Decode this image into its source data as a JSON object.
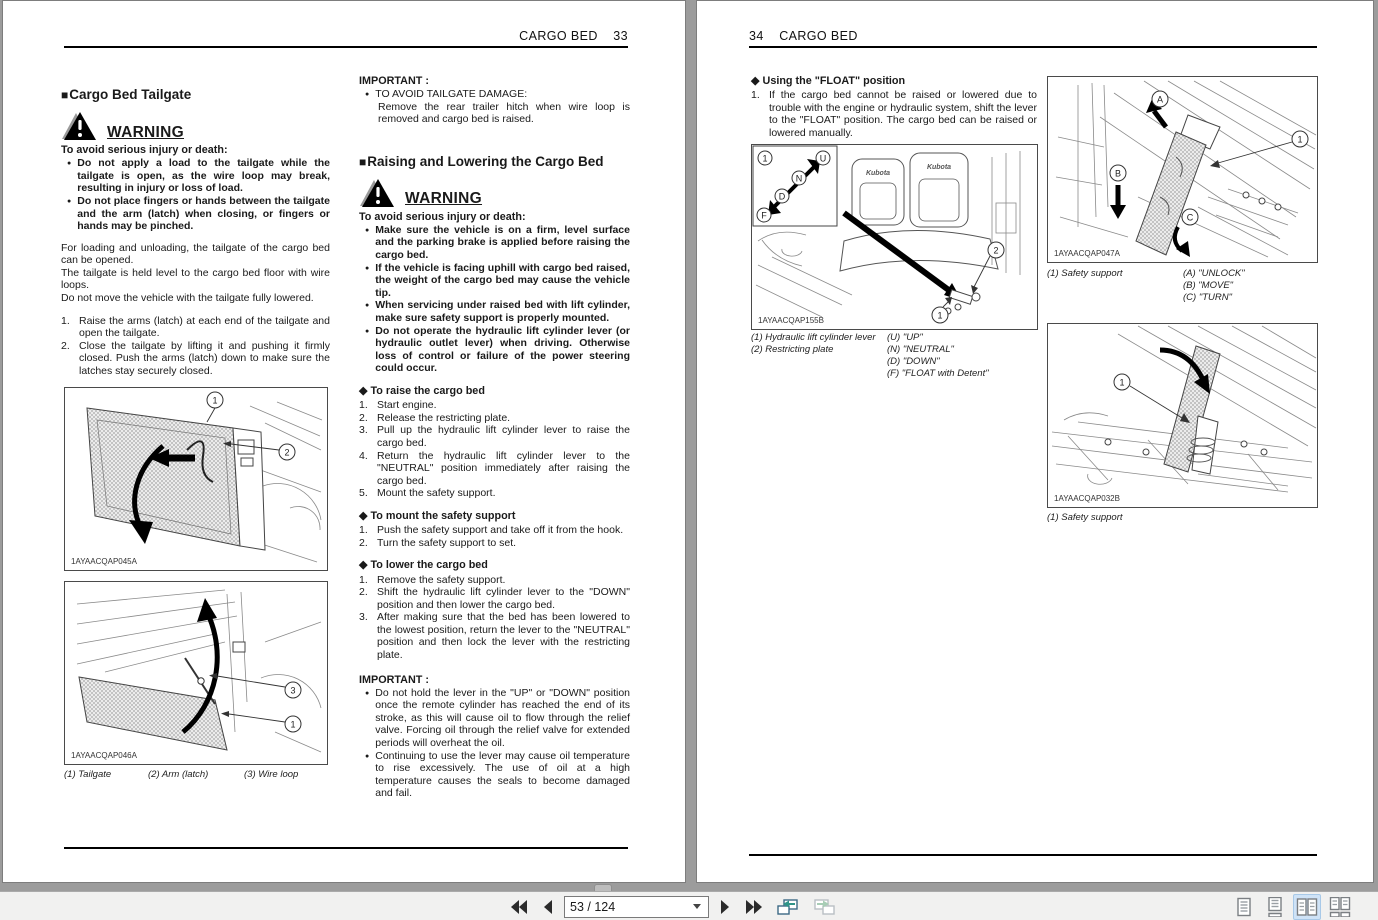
{
  "toolbar": {
    "page_indicator": "53 / 124"
  },
  "colors": {
    "canvas_gray": "#9c9c9c",
    "toolbar_bg": "#f1f1f0",
    "selected_view_bg": "#cfe3f7",
    "selected_view_border": "#a8c9e8",
    "back_view_accent": "#2f9488",
    "nav_icon": "#2b2b2b",
    "page_border": "#7d7d7d"
  },
  "left_page": {
    "header": {
      "title": "CARGO BED",
      "number": "33"
    },
    "section1": {
      "heading": "Cargo Bed Tailgate",
      "warning": {
        "label": "WARNING",
        "lead": "To avoid serious injury or death:",
        "bullets": [
          "Do not apply a load to the tailgate while the tailgate is open, as the wire loop may break, resulting in injury or loss of load.",
          "Do not place fingers or hands between the tailgate and the arm (latch) when closing, or fingers or hands may be pinched."
        ]
      },
      "paragraphs": [
        "For loading and unloading, the tailgate of the cargo bed can be opened.",
        "The tailgate is held level to the cargo bed floor with wire loops.",
        "Do not move the vehicle with the tailgate fully lowered."
      ],
      "steps": [
        {
          "n": "1.",
          "t": "Raise the arms (latch) at each end of the tailgate and open the tailgate."
        },
        {
          "n": "2.",
          "t": "Close the tailgate by lifting it and pushing it firmly closed. Push the arms (latch) down to make sure the latches stay securely closed."
        }
      ],
      "figure_tailgate_closed": {
        "code": "1AYAACQAP045A",
        "callouts": [
          "1",
          "2"
        ]
      },
      "figure_tailgate_open": {
        "code": "1AYAACQAP046A",
        "callouts": [
          "3",
          "1"
        ],
        "captions": [
          "(1) Tailgate",
          "(2) Arm (latch)",
          "(3) Wire loop"
        ]
      }
    },
    "important1": {
      "label": "IMPORTANT :",
      "bullet": "TO AVOID TAILGATE DAMAGE:",
      "text": "Remove the rear trailer hitch when wire loop is removed and cargo bed is raised."
    },
    "section2": {
      "heading": "Raising and Lowering the Cargo Bed",
      "warning": {
        "label": "WARNING",
        "lead": "To avoid serious injury or death:",
        "bullets": [
          "Make sure the vehicle is on a firm, level surface and the parking brake is applied before raising the cargo bed.",
          "If the vehicle is facing uphill with cargo bed raised, the weight of the cargo bed may cause the vehicle tip.",
          "When servicing under raised bed with lift cylinder, make sure safety support is properly mounted.",
          "Do not operate the hydraulic lift cylinder lever (or hydraulic outlet lever) when driving. Otherwise loss of control or failure of the power steering could occur."
        ]
      },
      "raise": {
        "heading": "To raise the cargo bed",
        "steps": [
          {
            "n": "1.",
            "t": "Start engine."
          },
          {
            "n": "2.",
            "t": "Release the restricting plate."
          },
          {
            "n": "3.",
            "t": "Pull up the hydraulic lift cylinder lever to raise the cargo bed."
          },
          {
            "n": "4.",
            "t": "Return the hydraulic lift cylinder lever to the \"NEUTRAL\" position immediately after raising the cargo bed."
          },
          {
            "n": "5.",
            "t": "Mount the safety support."
          }
        ]
      },
      "mount": {
        "heading": "To mount the safety support",
        "steps": [
          {
            "n": "1.",
            "t": "Push the safety support and take off it from the hook."
          },
          {
            "n": "2.",
            "t": "Turn the safety support to set."
          }
        ]
      },
      "lower": {
        "heading": "To lower the cargo bed",
        "steps": [
          {
            "n": "1.",
            "t": "Remove the safety support."
          },
          {
            "n": "2.",
            "t": "Shift the hydraulic lift cylinder lever to the \"DOWN\" position and then lower the cargo bed."
          },
          {
            "n": "3.",
            "t": "After making sure that the bed has been lowered to the lowest position, return the lever to the \"NEUTRAL\" position and then lock the lever with the restricting plate."
          }
        ]
      },
      "important": {
        "label": "IMPORTANT :",
        "bullets": [
          "Do not hold the lever in the \"UP\" or \"DOWN\" position once the remote cylinder has reached the end of its stroke, as this will cause oil to flow through the relief valve. Forcing oil through the relief valve for extended periods will overheat the oil.",
          "Continuing to use the lever may cause oil temperature to rise excessively. The use of oil at a high temperature causes the seals to become damaged and fail."
        ]
      }
    }
  },
  "right_page": {
    "header": {
      "number": "34",
      "title": "CARGO BED"
    },
    "float_section": {
      "heading": "Using the \"FLOAT\" position",
      "steps": [
        {
          "n": "1.",
          "t": "If the cargo bed cannot be raised or lowered due to trouble with the engine or hydraulic system, shift the lever to the \"FLOAT\" position. The cargo bed can be raised or lowered manually."
        }
      ]
    },
    "figure_lever": {
      "code": "1AYAACQAP155B",
      "seat_label": "Kubota",
      "callouts": {
        "c1": "1",
        "c2": "2",
        "u": "U",
        "n": "N",
        "d": "D",
        "f": "F"
      },
      "captions_left": [
        "(1) Hydraulic lift cylinder lever",
        "(2) Restricting plate"
      ],
      "captions_right": [
        "(U) \"UP\"",
        "(N) \"NEUTRAL\"",
        "(D) \"DOWN\"",
        "(F) \"FLOAT with Detent\""
      ]
    },
    "figure_safety_support_set": {
      "code": "1AYAACQAP047A",
      "callouts": {
        "a": "A",
        "b": "B",
        "c": "C",
        "c1": "1"
      },
      "captions_left": [
        "(1) Safety support"
      ],
      "captions_right": [
        "(A) \"UNLOCK\"",
        "(B) \"MOVE\"",
        "(C) \"TURN\""
      ]
    },
    "figure_safety_support_stored": {
      "code": "1AYAACQAP032B",
      "callouts": {
        "c1": "1"
      },
      "captions_left": [
        "(1) Safety support"
      ]
    }
  }
}
